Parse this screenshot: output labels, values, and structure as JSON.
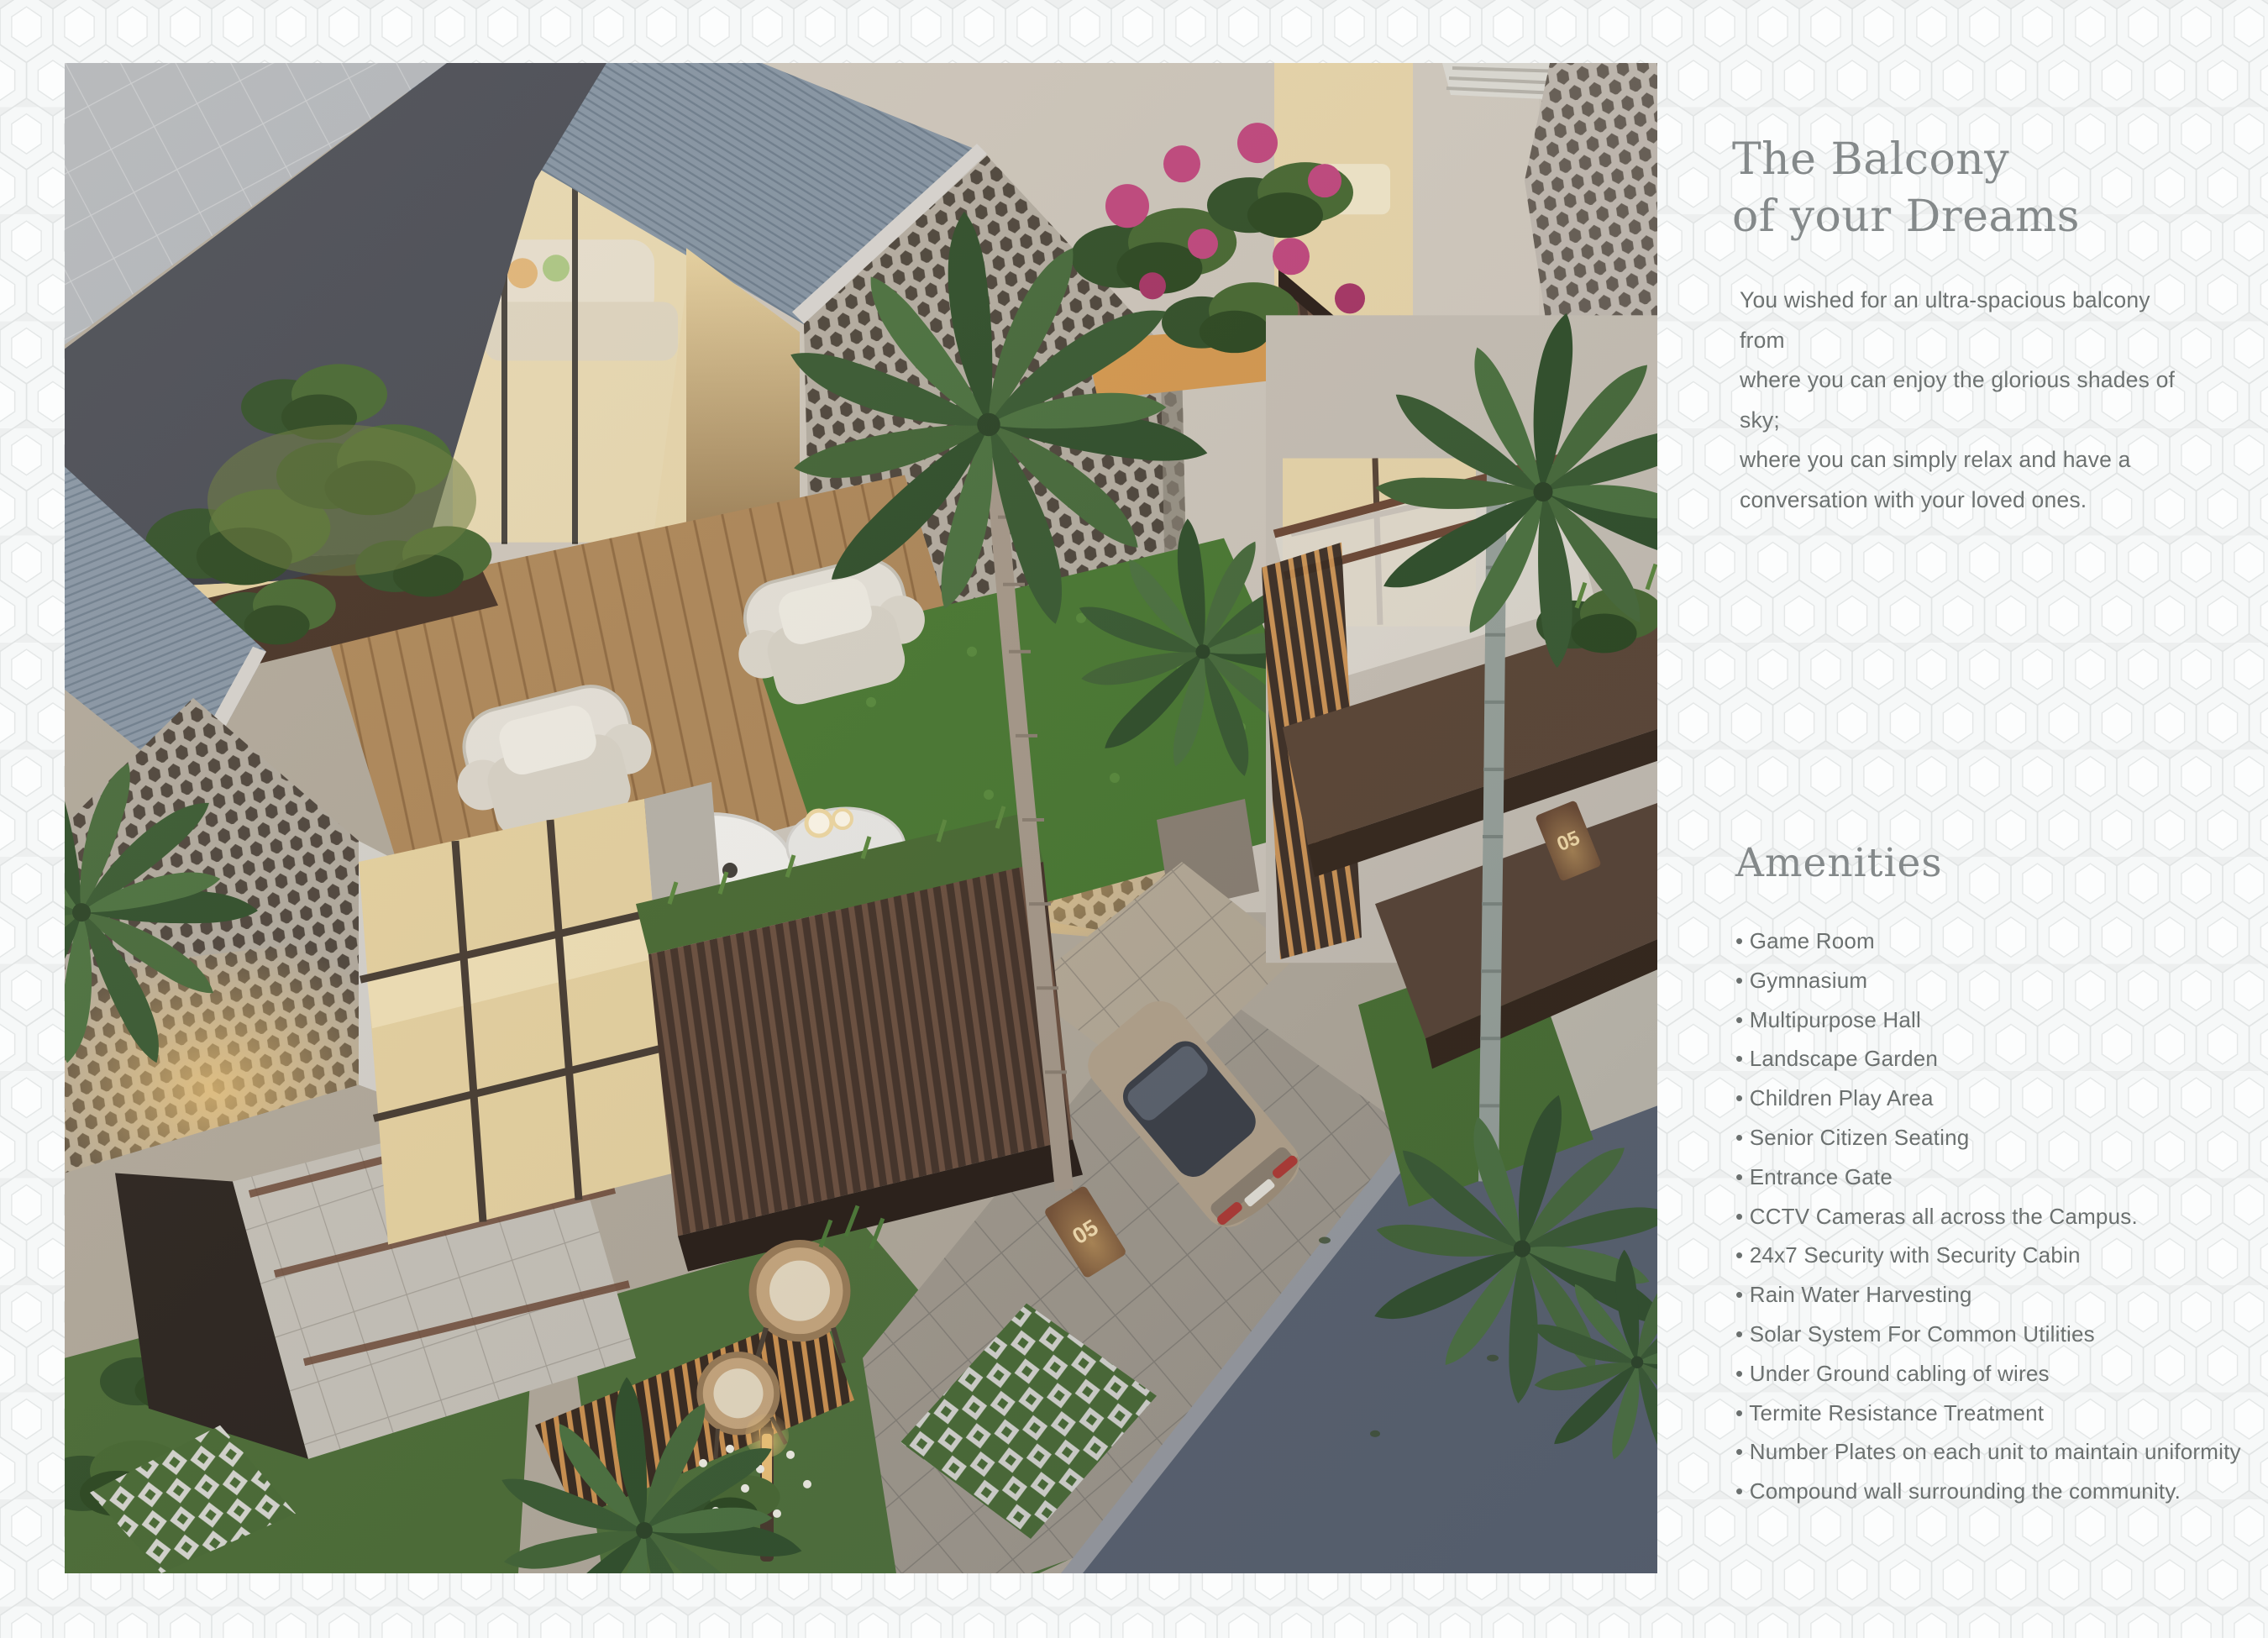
{
  "page": {
    "background_color": "#edefef",
    "pattern": "honeycomb-hexagons",
    "pattern_line_color": "#e1e4e4"
  },
  "hero_image": {
    "alt": "Aerial dusk render of modern row villas with hexagon-screen gables, balconies, palms, lawns, a parked car and a street",
    "unit_number": "05"
  },
  "headline": {
    "title": "The Balcony\nof your Dreams",
    "color": "#84898a"
  },
  "intro": {
    "text": "You wished for an ultra-spacious balcony from\nwhere you can enjoy the glorious shades of sky;\nwhere you can simply relax and have a\nconversation with your loved ones.",
    "color": "#6d7271"
  },
  "amenities": {
    "heading": "Amenities",
    "bullet": "•",
    "items": [
      "Game Room",
      "Gymnasium",
      "Multipurpose Hall",
      "Landscape Garden",
      "Children Play Area",
      "Senior Citizen Seating",
      "Entrance Gate",
      "CCTV Cameras all across the Campus.",
      "24x7 Security with Security Cabin",
      "Rain Water Harvesting",
      "Solar System For Common Utilities",
      "Under Ground cabling of wires",
      "Termite Resistance Treatment",
      "Number Plates on each unit to maintain uniformity",
      "Compound wall surrounding the community."
    ]
  }
}
